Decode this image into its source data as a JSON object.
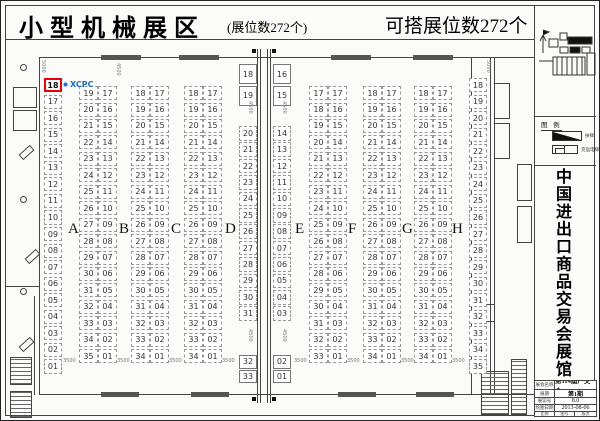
{
  "header": {
    "title": "小型机械展区",
    "booth_count_note": "(展位数272个)",
    "buildable_note": "可搭展位数272个"
  },
  "plan": {
    "highlight_booth": "18",
    "logo_text": "XCPC",
    "section_labels": [
      "A",
      "B",
      "C",
      "D",
      "E",
      "F",
      "G",
      "H"
    ],
    "left_wall": [
      "18",
      "17",
      "16",
      "15",
      "14",
      "13",
      "12",
      "11",
      "10",
      "09",
      "08",
      "07",
      "06",
      "05",
      "04",
      "03",
      "02",
      "01"
    ],
    "b_left": [
      "19",
      "20",
      "21",
      "22",
      "23",
      "24",
      "25",
      "26",
      "27",
      "28",
      "29",
      "30",
      "31",
      "32",
      "33",
      "34",
      "35"
    ],
    "b_right": [
      "17",
      "16",
      "15",
      "14",
      "13",
      "12",
      "11",
      "10",
      "09",
      "08",
      "07",
      "06",
      "05",
      "04",
      "03",
      "02",
      "01"
    ],
    "c_left": [
      "18",
      "19",
      "20",
      "21",
      "22",
      "23",
      "24",
      "25",
      "26",
      "27",
      "28",
      "29",
      "30",
      "31",
      "32",
      "33",
      "34"
    ],
    "c_right": [
      "17",
      "16",
      "15",
      "14",
      "13",
      "12",
      "11",
      "10",
      "09",
      "08",
      "07",
      "06",
      "05",
      "04",
      "03",
      "02",
      "01"
    ],
    "d_left": [
      "18",
      "19",
      "20",
      "21",
      "22",
      "23",
      "24",
      "25",
      "26",
      "27",
      "28",
      "29",
      "30",
      "31",
      "32",
      "33",
      "34"
    ],
    "d_right": [
      "17",
      "16",
      "15",
      "14",
      "13",
      "12",
      "11",
      "10",
      "09",
      "08",
      "07",
      "06",
      "05",
      "04",
      "03",
      "02",
      "01"
    ],
    "aisle_west": {
      "top": [
        "18",
        "19"
      ],
      "mid": [
        "20",
        "21",
        "22",
        "23",
        "24",
        "25",
        "26",
        "27",
        "28",
        "29",
        "30",
        "31"
      ],
      "bottom": [
        "32",
        "33"
      ]
    },
    "aisle_east": {
      "top": [
        "16",
        "15"
      ],
      "mid": [
        "14",
        "13",
        "12",
        "11",
        "10",
        "09",
        "08",
        "07",
        "06",
        "05",
        "04",
        "03"
      ],
      "bottom": [
        "02",
        "01"
      ]
    },
    "f_left": [
      "17",
      "18",
      "19",
      "20",
      "21",
      "22",
      "23",
      "24",
      "25",
      "26",
      "27",
      "28",
      "29",
      "30",
      "31",
      "32",
      "33"
    ],
    "f_right": [
      "17",
      "16",
      "15",
      "14",
      "13",
      "12",
      "11",
      "10",
      "09",
      "08",
      "07",
      "06",
      "05",
      "04",
      "03",
      "02",
      "01"
    ],
    "g_left": [
      "18",
      "19",
      "20",
      "21",
      "22",
      "23",
      "24",
      "25",
      "26",
      "27",
      "28",
      "29",
      "30",
      "31",
      "32",
      "33",
      "34"
    ],
    "g_right": [
      "17",
      "16",
      "15",
      "14",
      "13",
      "12",
      "11",
      "10",
      "09",
      "08",
      "07",
      "06",
      "05",
      "04",
      "03",
      "02",
      "01"
    ],
    "h_left": [
      "18",
      "19",
      "20",
      "21",
      "22",
      "23",
      "24",
      "25",
      "26",
      "27",
      "28",
      "29",
      "30",
      "31",
      "32",
      "33",
      "34"
    ],
    "h_right": [
      "17",
      "16",
      "15",
      "14",
      "13",
      "12",
      "11",
      "10",
      "09",
      "08",
      "07",
      "06",
      "05",
      "04",
      "03",
      "02",
      "01"
    ],
    "right_wall": [
      "18",
      "19",
      "20",
      "21",
      "22",
      "23",
      "24",
      "25",
      "26",
      "27",
      "28",
      "29",
      "30",
      "31",
      "32",
      "33",
      "34",
      "35"
    ],
    "dim_h": "3500",
    "dim_v": "4500",
    "dim_v2": "5000"
  },
  "sidebar": {
    "legend": {
      "title": "图 例",
      "items": [
        {
          "label": "扶梯"
        },
        {
          "label": "货运电梯"
        }
      ]
    },
    "vertical_title": "中国进出口商品交易会展馆",
    "titleblock": {
      "rows": [
        {
          "label": "展会名称",
          "value": "第114届广交会"
        },
        {
          "label": "展期",
          "value": "第1期"
        },
        {
          "label": "展馆号",
          "value": "8.0"
        },
        {
          "label": "绘图日期",
          "value": "2013-08-06"
        }
      ],
      "footer_cells": [
        "比例",
        "图号",
        "版次"
      ]
    }
  }
}
